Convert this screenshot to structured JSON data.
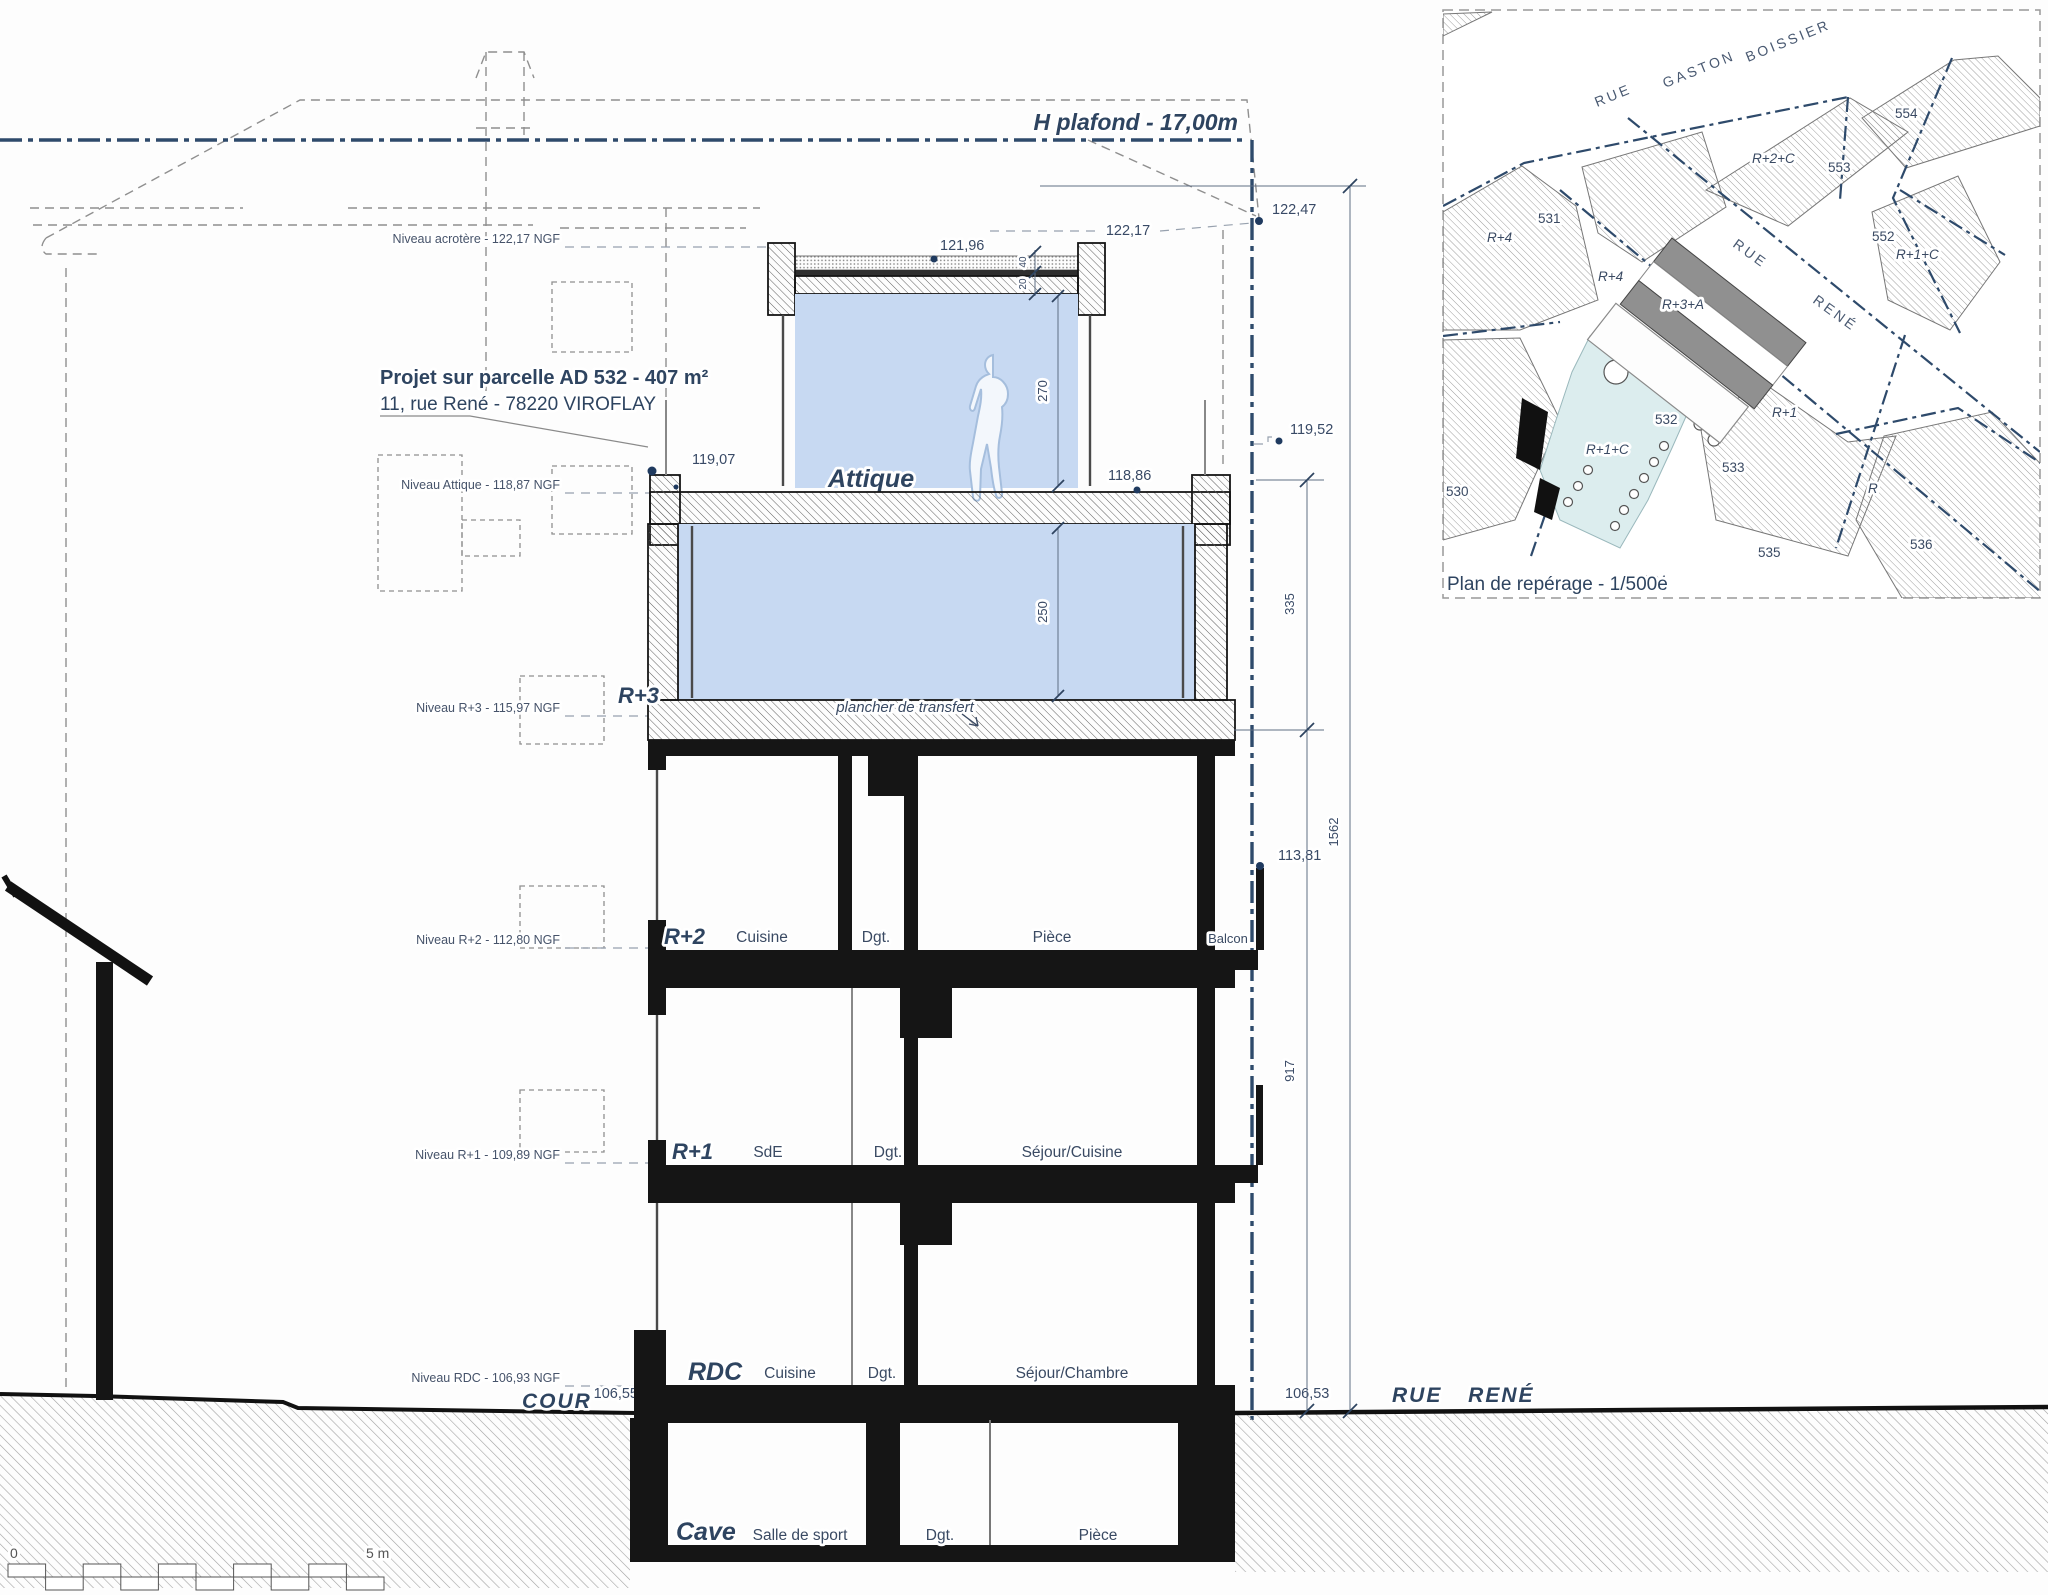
{
  "colors": {
    "accent_blue": "#2e4a6b",
    "room_fill": "#c7d9f2",
    "line_black": "#151515",
    "garden_fill": "#dcedee",
    "roof_gray": "#909090"
  },
  "section": {
    "ceiling_line": "H plafond - 17,00m",
    "levels": [
      "Niveau acrotère - 122,17 NGF",
      "Niveau Attique - 118,87 NGF",
      "Niveau R+3 - 115,97 NGF",
      "Niveau R+2 - 112,80 NGF",
      "Niveau R+1 - 109,89 NGF",
      "Niveau RDC - 106,93 NGF"
    ],
    "project": [
      "Projet sur parcelle AD 532 - 407 m²",
      "11, rue René - 78220 VIROFLAY"
    ],
    "elevations": {
      "roof_right": "122,47",
      "roof_dashed": "122,17",
      "attic_roof": "121,96",
      "attic_left": "119,07",
      "attic_right": "118,86",
      "right_upper": "119,52",
      "balcony": "113,81",
      "cour": "106,55",
      "street": "106,53"
    },
    "dims": {
      "roof_a": "40",
      "roof_b": "20",
      "attic_h": "270",
      "r3_h": "250",
      "seg_a": "335",
      "seg_b": "917",
      "total": "1562"
    },
    "floors": {
      "attique": {
        "name": "Attique"
      },
      "r3": {
        "name": "R+3",
        "note": "plancher de transfert"
      },
      "r2": {
        "name": "R+2",
        "rooms": [
          "Cuisine",
          "Dgt.",
          "Pièce",
          "Balcon"
        ]
      },
      "r1": {
        "name": "R+1",
        "rooms": [
          "SdE",
          "Dgt.",
          "Séjour/Cuisine"
        ]
      },
      "rdc": {
        "name": "RDC",
        "rooms": [
          "Cuisine",
          "Dgt.",
          "Séjour/Chambre"
        ]
      },
      "cave": {
        "name": "Cave",
        "rooms": [
          "Salle de sport",
          "Dgt.",
          "Pièce"
        ]
      }
    },
    "ground": {
      "left": "COUR",
      "right": "RUE RENÉ"
    },
    "scalebar": {
      "start": "0",
      "end": "5 m"
    }
  },
  "inset": {
    "caption": "Plan de repérage - 1/500e",
    "street_top": [
      "RUE",
      "GASTON",
      "BOISSIER"
    ],
    "street_right": [
      "RUE",
      "RENÉ"
    ],
    "parcels": [
      "530",
      "531",
      "532",
      "533",
      "534",
      "535",
      "536",
      "552",
      "553",
      "554"
    ],
    "buildings": [
      "R+4",
      "R+4",
      "R+3+A",
      "R+2+C",
      "R+1+C",
      "R+1+C",
      "R+1",
      "R"
    ]
  }
}
